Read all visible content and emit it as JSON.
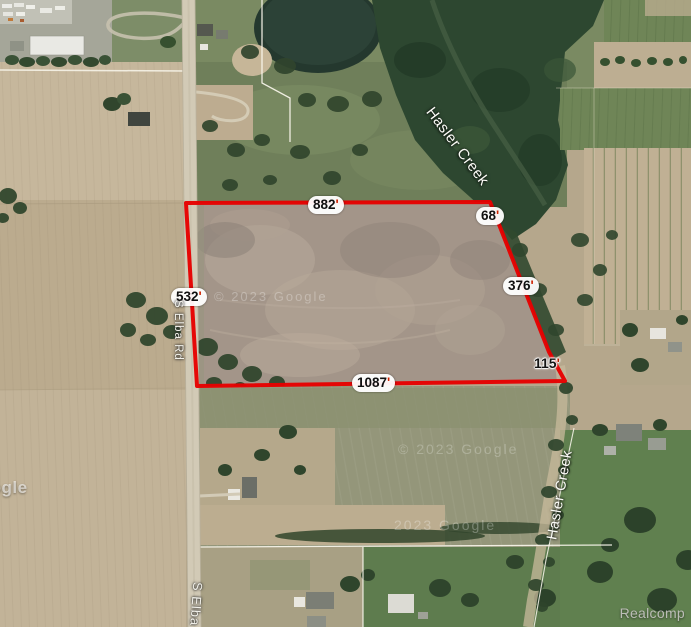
{
  "map": {
    "parcel": {
      "outline_color": "#e60000",
      "dimensions": [
        {
          "side": "north",
          "value": "882",
          "unit": "'"
        },
        {
          "side": "northeast",
          "value": "68",
          "unit": "'"
        },
        {
          "side": "east",
          "value": "376",
          "unit": "'"
        },
        {
          "side": "southeast",
          "value": "115",
          "unit": "'"
        },
        {
          "side": "south",
          "value": "1087",
          "unit": "'"
        },
        {
          "side": "west",
          "value": "532",
          "unit": "'"
        }
      ]
    },
    "roads": [
      {
        "name": "S Elba Rd"
      },
      {
        "name": "S Elba Rd"
      }
    ],
    "waterways": [
      {
        "name": "Hasler Creek"
      },
      {
        "name": "Hasler Creek"
      }
    ],
    "watermarks": {
      "upper": "© 2023 Google",
      "middle": "© 2023 Google",
      "lower": "2023 Google",
      "logo": "Google",
      "provider": "Realcomp"
    }
  }
}
